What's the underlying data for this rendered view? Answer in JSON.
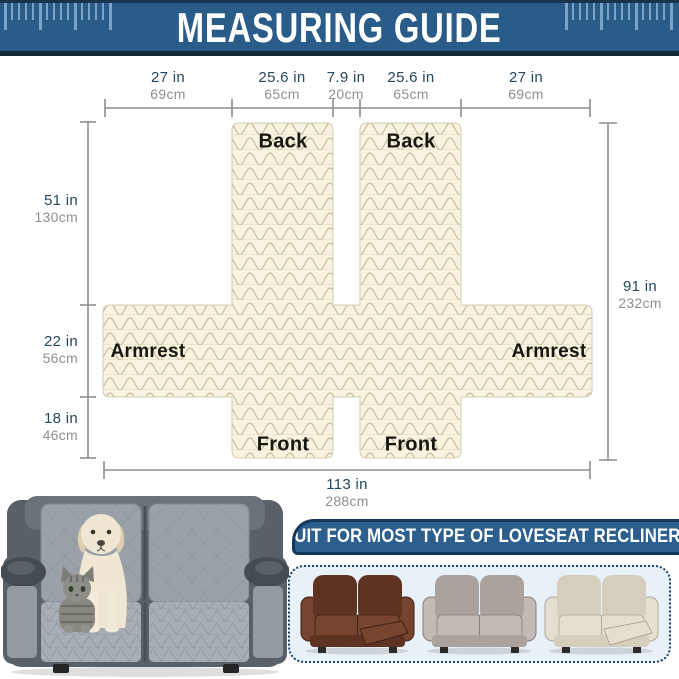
{
  "header": {
    "title": "MEASURING GUIDE"
  },
  "diagram": {
    "top_measurements": [
      {
        "inches": "27 in",
        "cm": "69cm"
      },
      {
        "inches": "25.6 in",
        "cm": "65cm"
      },
      {
        "inches": "7.9 in",
        "cm": "20cm"
      },
      {
        "inches": "25.6 in",
        "cm": "65cm"
      },
      {
        "inches": "27 in",
        "cm": "69cm"
      }
    ],
    "left_measurements": [
      {
        "inches": "51 in",
        "cm": "130cm"
      },
      {
        "inches": "22 in",
        "cm": "56cm"
      },
      {
        "inches": "18 in",
        "cm": "46cm"
      }
    ],
    "right_measurement": {
      "inches": "91 in",
      "cm": "232cm"
    },
    "bottom_measurement": {
      "inches": "113 in",
      "cm": "288cm"
    },
    "panel_labels": {
      "back_left": "Back",
      "back_right": "Back",
      "armrest_left": "Armrest",
      "armrest_right": "Armrest",
      "front_left": "Front",
      "front_right": "Front"
    }
  },
  "footer": {
    "banner_text": "SUIT FOR MOST TYPE OF LOVESEAT RECLINERS",
    "product_photo": {
      "vars": "--cover:#9aa1a8;--cover2:#a8aeb5;--base:#5a6067;--dog:#efe7d3;--cat:#8e8e88"
    },
    "recliners": [
      {
        "name": "brown-leather-recliner",
        "vars": "--c1:#5e3322;--c2:#77452f;--c3:#3f2015"
      },
      {
        "name": "taupe-fabric-recliner",
        "vars": "--c1:#aaa29c;--c2:#c2bab4;--c3:#877d77"
      },
      {
        "name": "beige-leather-recliner",
        "vars": "--c1:#d5cebd;--c2:#e5dfd1;--c3:#b0a894"
      }
    ]
  },
  "colors": {
    "header_bg": "#2a5c8a",
    "header_strip": "#16344d",
    "header_bottom": "#142938",
    "ruler_tick": "#7ba3c8",
    "banner_bg": "#2c5e8e",
    "banner_border": "#14375c",
    "panel_bg": "#e9f1f8",
    "fabric": "#f8f2e0",
    "fabric_line": "#bfb69a",
    "inch_text": "#26475c",
    "cm_text": "#8f9091",
    "measure_line": "#8d8d8d"
  }
}
